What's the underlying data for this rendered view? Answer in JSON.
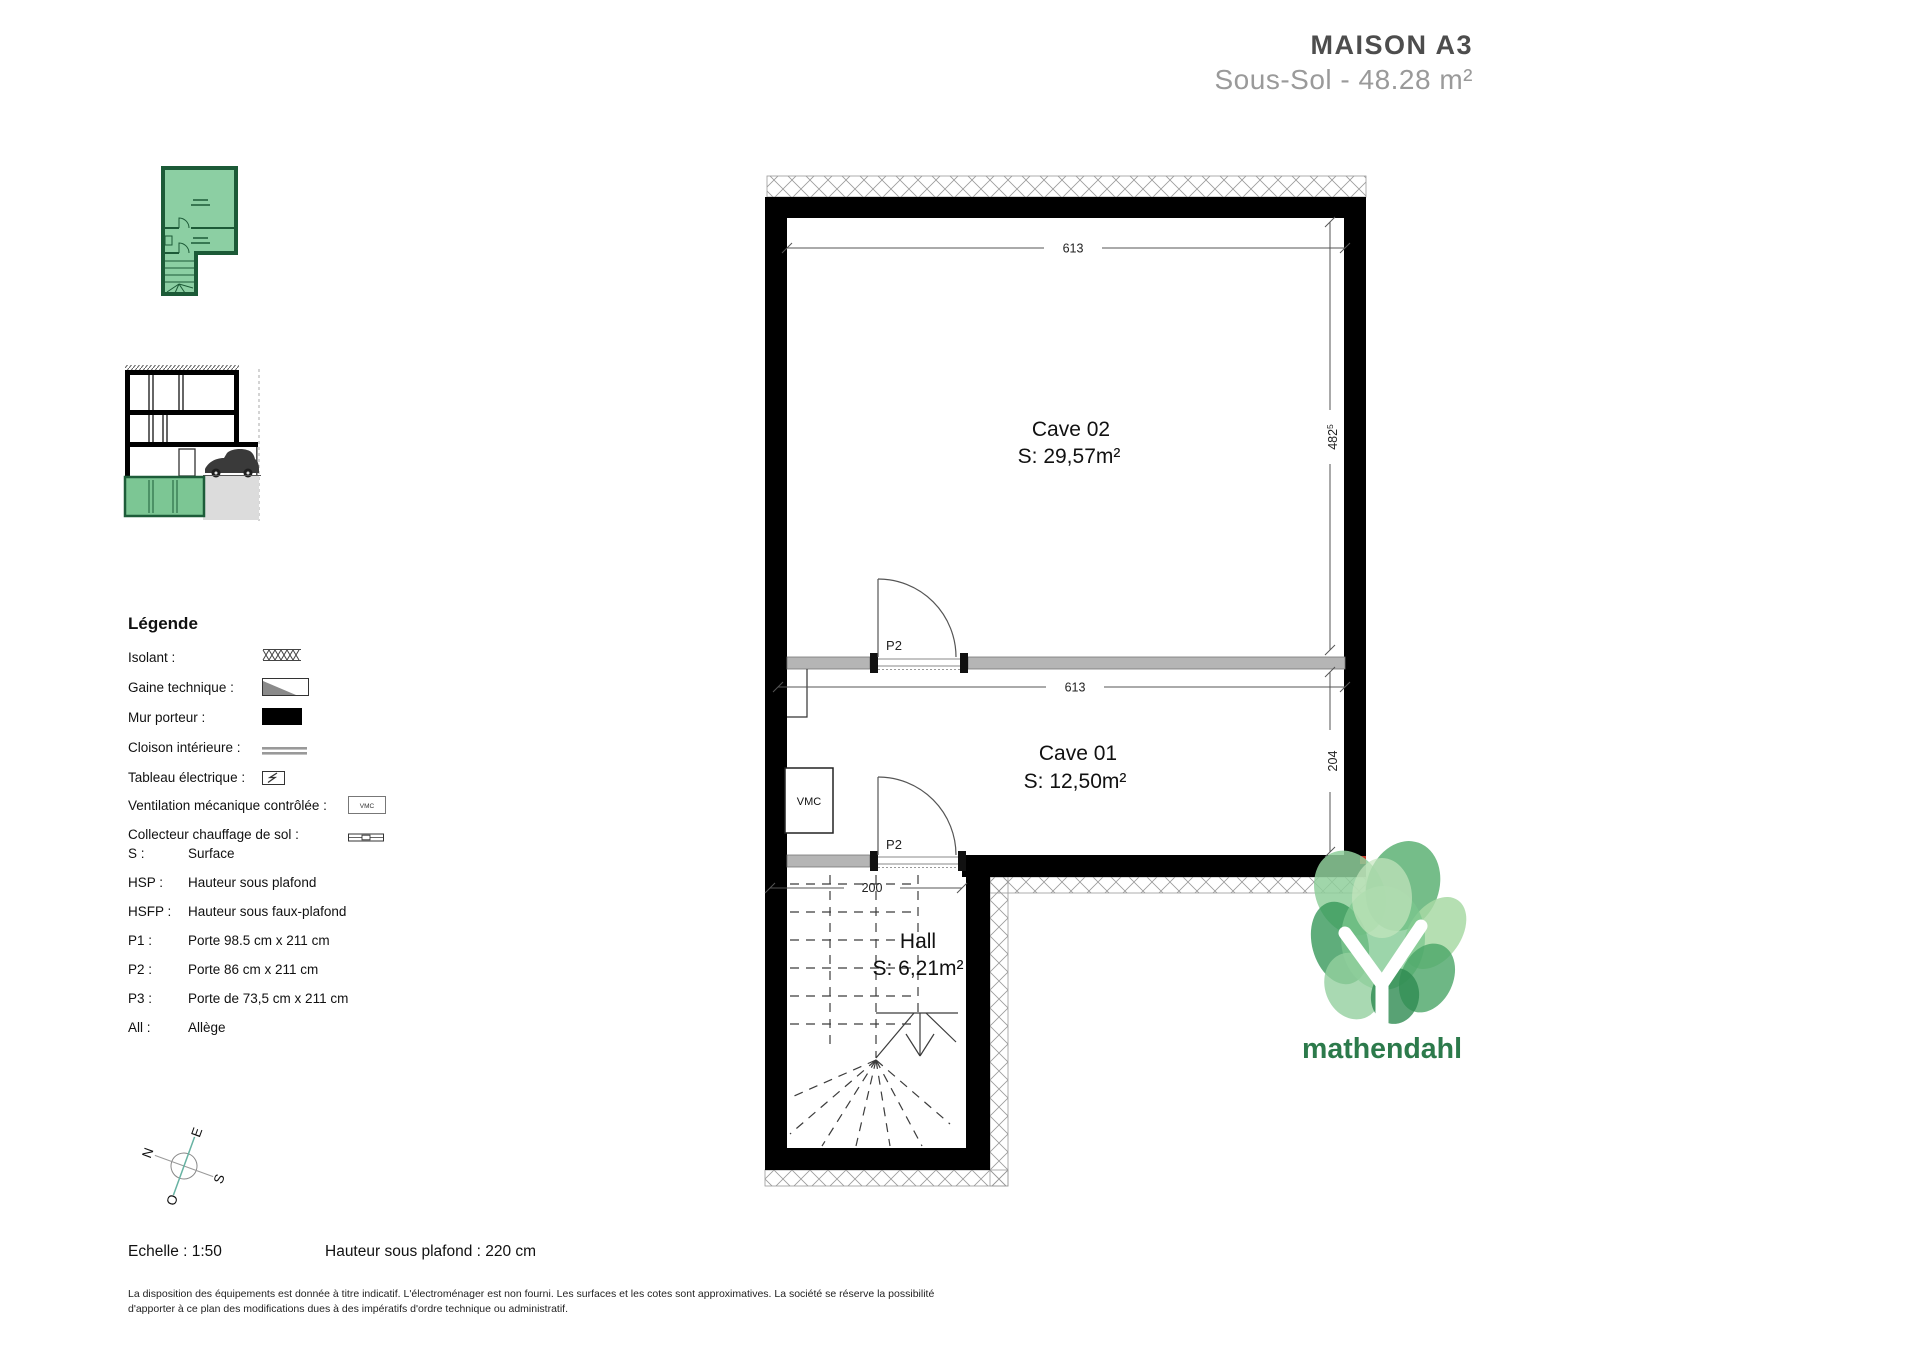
{
  "header": {
    "title": "MAISON A3",
    "subtitle": "Sous-Sol - 48.28 m²"
  },
  "legend": {
    "heading": "Légende",
    "items": [
      {
        "label": "Isolant :"
      },
      {
        "label": "Gaine technique :"
      },
      {
        "label": "Mur porteur :"
      },
      {
        "label": "Cloison intérieure :"
      },
      {
        "label": "Tableau électrique :"
      },
      {
        "label": "Ventilation mécanique contrôlée :"
      },
      {
        "label": "Collecteur chauffage de sol :"
      }
    ],
    "vmc_symbol_text": "VMC",
    "abbreviations": [
      {
        "abbr": "S :",
        "meaning": "Surface"
      },
      {
        "abbr": "HSP :",
        "meaning": "Hauteur sous plafond"
      },
      {
        "abbr": "HSFP :",
        "meaning": "Hauteur sous faux-plafond"
      },
      {
        "abbr": "P1 :",
        "meaning": "Porte 98.5 cm x 211 cm"
      },
      {
        "abbr": "P2 :",
        "meaning": "Porte 86 cm x 211 cm"
      },
      {
        "abbr": "P3 :",
        "meaning": "Porte de 73,5 cm x 211 cm"
      },
      {
        "abbr": "All :",
        "meaning": "Allège"
      }
    ]
  },
  "plan": {
    "rooms": [
      {
        "name": "Cave 02",
        "surface": "S: 29,57m²"
      },
      {
        "name": "Cave 01",
        "surface": "S: 12,50m²"
      },
      {
        "name": "Hall",
        "surface": "S: 6,21m²"
      }
    ],
    "labels": {
      "vmc": "VMC",
      "door_top": "P2",
      "door_bottom": "P2"
    },
    "dimensions": {
      "top_width": "613",
      "mid_width": "613",
      "right_upper": "482",
      "right_upper_sup": "5",
      "right_lower": "204",
      "hall_width": "200"
    }
  },
  "compass": {
    "n": "N",
    "e": "E",
    "s": "S",
    "o": "O"
  },
  "footer": {
    "scale": "Echelle : 1:50",
    "ceiling": "Hauteur sous plafond : 220 cm",
    "disclaimer1": "La disposition des équipements est donnée à titre indicatif. L'électroménager est non fourni. Les surfaces et les cotes sont approximatives. La société se réserve la possibilité",
    "disclaimer2": "d'apporter à ce plan des modifications dues à des impératifs d'ordre technique ou administratif."
  },
  "logo": {
    "wordmark": "mathendahl"
  },
  "colors": {
    "plan_wall": "#000000",
    "partition_gray": "#b5b5b5",
    "highlight_green": "#8ccfa3",
    "logo_green": "#2c7a4b",
    "title_gray": "#4d4d4d",
    "subtitle_gray": "#9a9a9a"
  }
}
